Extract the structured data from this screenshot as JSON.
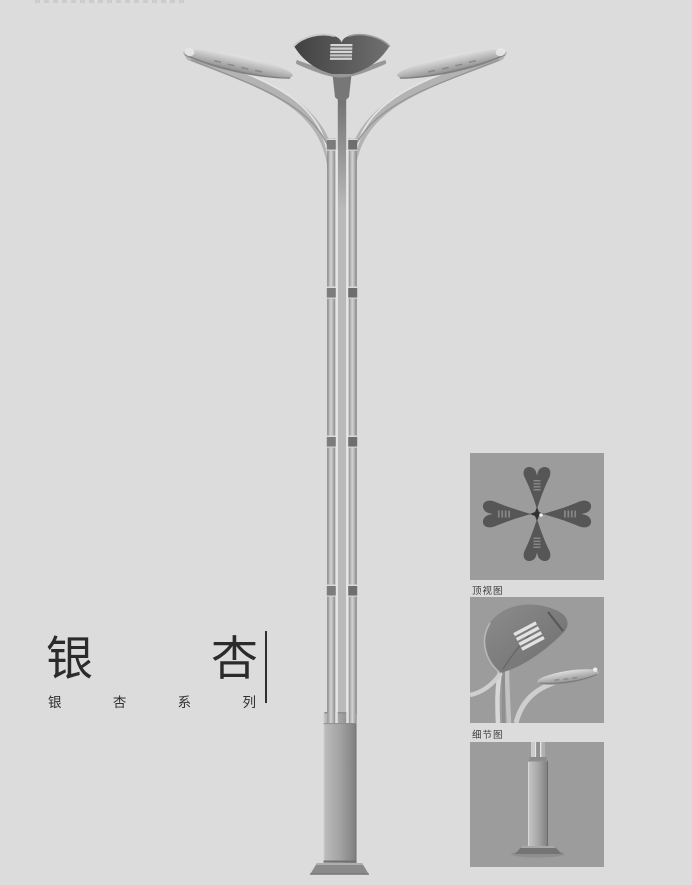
{
  "colors": {
    "page_bg": "#dcdcdc",
    "panel_bg": "#9c9c9c",
    "title_text": "#2b2b2b",
    "caption_text": "#3b3b3b",
    "lamp_dark": "#4a4a4a",
    "lamp_metal": "#b5b5b5"
  },
  "title": {
    "text": "银杏",
    "char1": "银",
    "char2": "杏"
  },
  "series": {
    "text": "银杏系列",
    "char1": "银",
    "char2": "杏",
    "char3": "系",
    "char4": "列"
  },
  "panels": {
    "top_view": {
      "caption": "顶视图"
    },
    "detail": {
      "caption": "细节图"
    }
  }
}
